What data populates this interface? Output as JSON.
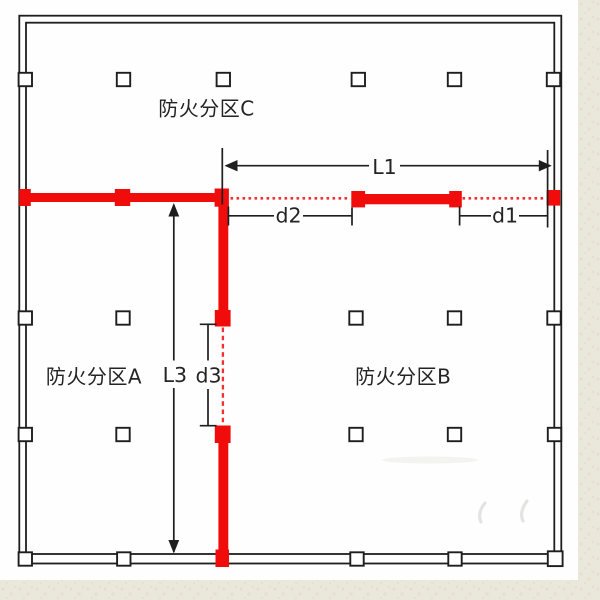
{
  "diagram": {
    "type": "fire-compartment-floor-plan",
    "zones": {
      "zone_a": {
        "label": "防火分区A"
      },
      "zone_b": {
        "label": "防火分区B"
      },
      "zone_c": {
        "label": "防火分区C"
      }
    },
    "dimensions": {
      "l1": {
        "label": "L1"
      },
      "d1": {
        "label": "d1"
      },
      "d2": {
        "label": "d2"
      },
      "l3": {
        "label": "L3"
      },
      "d3": {
        "label": "d3"
      }
    }
  },
  "colors": {
    "fire_wall_red": "#f10c0c",
    "dashed_red": "#f23030",
    "line_dark": "#1e1e1e",
    "text_dark": "#242424",
    "canvas_white": "#fefefe",
    "column_white": "#ffffff",
    "border_beige": "#eae7db",
    "beige_speckle": "#dcd7c5",
    "watermark_gray": "#e4e3df"
  }
}
